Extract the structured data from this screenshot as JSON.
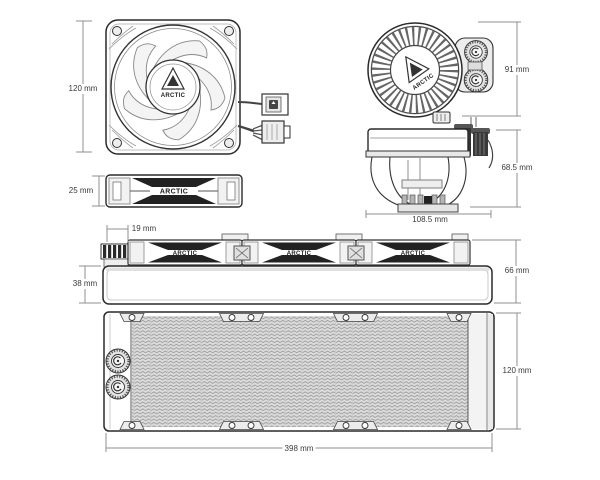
{
  "brand": "ARCTIC",
  "diagram": {
    "views": {
      "fan_front": {
        "height": "120 mm"
      },
      "pump_top": {
        "height": "91 mm"
      },
      "fan_side": {
        "thickness": "25 mm"
      },
      "pump_side": {
        "height": "68.5 mm",
        "width": "108.5 mm"
      },
      "assembly_side": {
        "fitting_overhang": "19 mm",
        "radiator_thickness": "38 mm",
        "total_height": "66 mm"
      },
      "radiator_top": {
        "width": "120 mm",
        "length": "398 mm"
      }
    }
  },
  "colors": {
    "line": "#2a2a2a",
    "dim_line": "#8f8f8f",
    "label_text": "#3a3a3a",
    "background": "#ffffff"
  }
}
